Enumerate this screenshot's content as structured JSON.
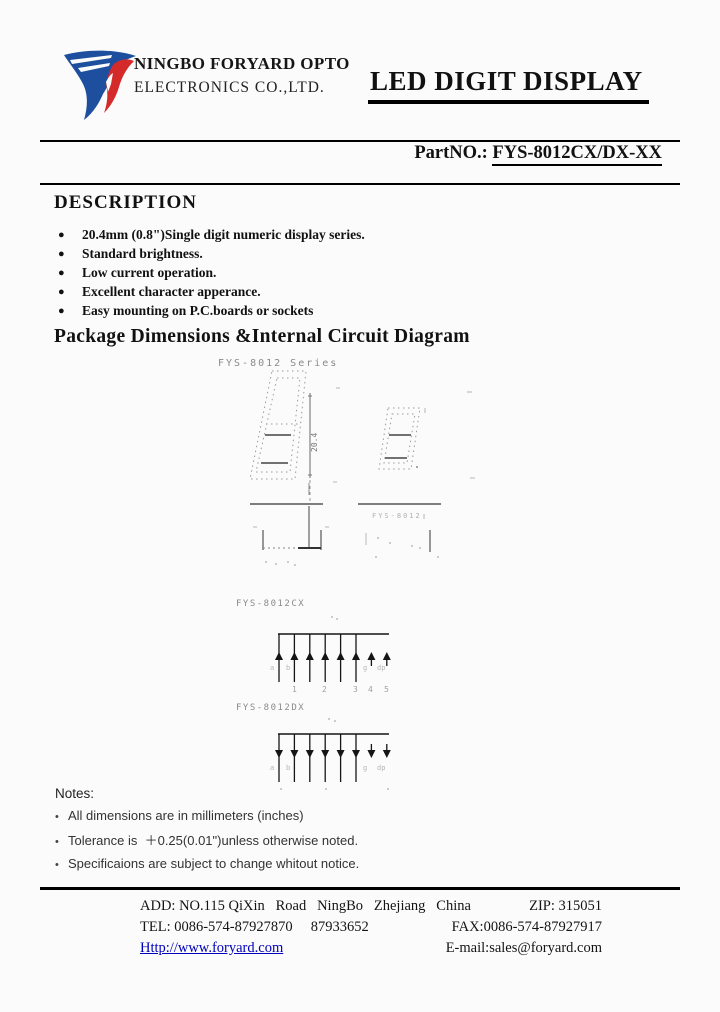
{
  "header": {
    "company_line1": "NINGBO FORYARD OPTO",
    "company_line2": "ELECTRONICS CO.,LTD.",
    "doc_title": "LED DIGIT DISPLAY",
    "part_label": "PartNO.: ",
    "part_number": "FYS-8012CX/DX-XX"
  },
  "description": {
    "heading": "DESCRIPTION",
    "bullets": [
      "20.4mm (0.8\")Single digit numeric display series.",
      "Standard brightness.",
      "Low current operation.",
      "Excellent character apperance.",
      "Easy mounting on P.C.boards or sockets"
    ]
  },
  "package_section": {
    "heading": "Package Dimensions &Internal Circuit Diagram",
    "series_label": "FYS-8012 Series",
    "height_dim": "20.4",
    "side_label": "FYS-8012",
    "cx": {
      "label": "FYS-8012CX",
      "segs": [
        "a",
        "b",
        "g",
        "dp"
      ],
      "pins": [
        "1",
        "2",
        "3",
        "4",
        "5"
      ]
    },
    "dx": {
      "label": "FYS-8012DX",
      "segs": [
        "a",
        "b",
        "g",
        "dp"
      ]
    }
  },
  "notes": {
    "heading": "Notes:",
    "items": [
      "All dimensions are in millimeters (inches)",
      "Tolerance is  ＋0.25(0.01\")unless otherwise noted.",
      "Specificaions are subject to change whitout notice."
    ]
  },
  "footer": {
    "address": "ADD: NO.115 QiXin   Road   NingBo   Zhejiang   China",
    "zip": "ZIP: 315051",
    "tel": "TEL: 0086-574-87927870     87933652",
    "fax": "FAX:0086-574-87927917",
    "website": "Http://www.foryard.com",
    "email": "E-mail:sales@foryard.com"
  },
  "colors": {
    "logo_blue": "#1d4f9e",
    "logo_red": "#d42a2a",
    "link_blue": "#0000bb"
  }
}
